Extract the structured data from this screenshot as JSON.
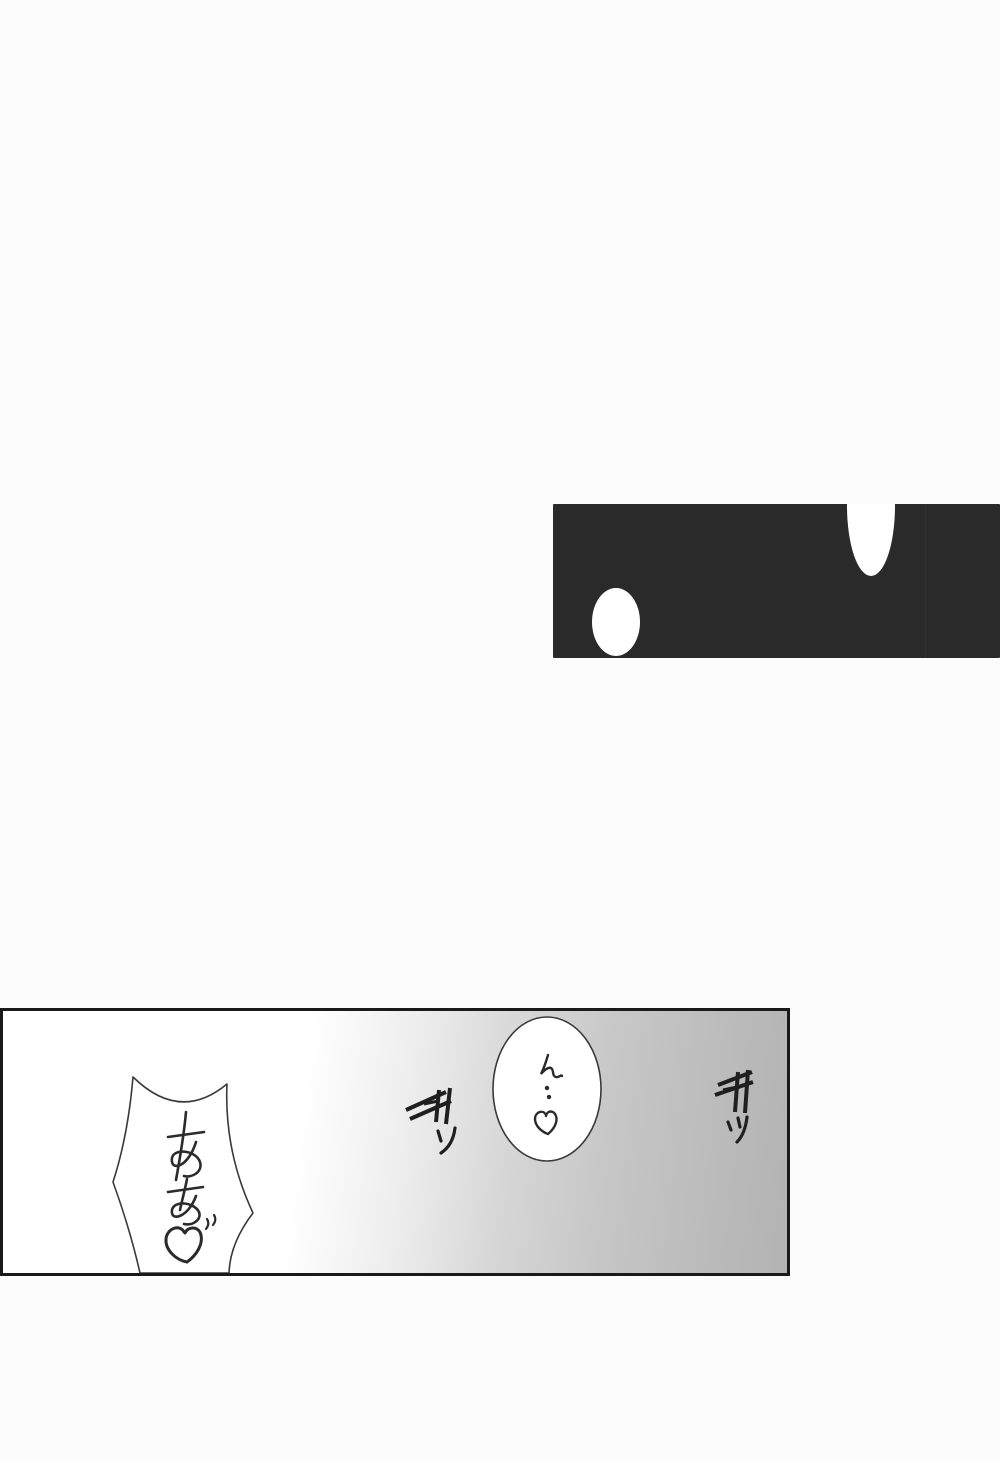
{
  "page": {
    "background": "#fcfcfc",
    "kind_label": "manga page"
  },
  "top_panel": {
    "fill": "#2a2a2a",
    "bubbles": [
      {
        "label": "blank white oval bubble (bottom left)",
        "fill": "#ffffff"
      },
      {
        "label": "blank white oval bubble clipped by panel top edge",
        "fill": "#ffffff"
      }
    ]
  },
  "bottom_panel": {
    "border_color": "#1a1a1a",
    "gradient_left": "#ffffff",
    "gradient_right": "#b3b3b3",
    "scream_bubble": {
      "text": "あぁ♡",
      "shape": "spiky concave burst bubble"
    },
    "moan_bubble": {
      "text": "ん‥♡",
      "shape": "oval bubble"
    },
    "sfx": [
      {
        "text": "ギッ",
        "position": "left"
      },
      {
        "text": "ギッ",
        "position": "right"
      }
    ],
    "ink_color": "#2b2b2b"
  }
}
